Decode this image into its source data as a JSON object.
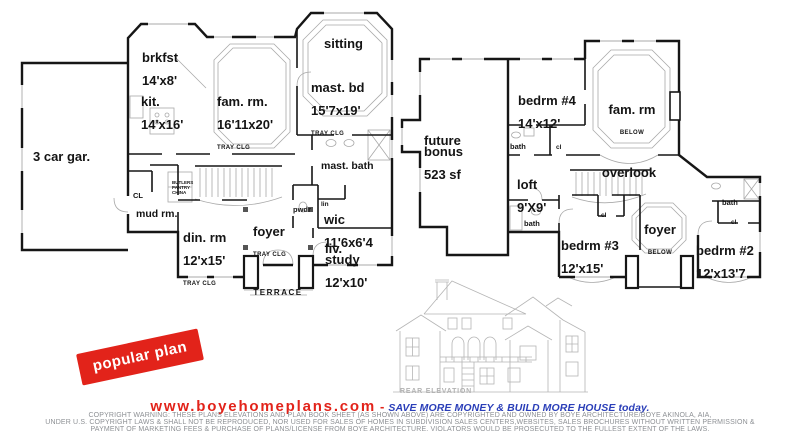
{
  "colors": {
    "wall": "#161616",
    "detail_gray": "#a9a9a9",
    "elevation_gray": "#b5b5b5",
    "stamp_red": "#e2231a",
    "website_red": "#e2231a",
    "tagline_blue": "#2a3eb8",
    "copyright_gray": "#8d9094"
  },
  "first_floor": {
    "garage": {
      "name": "3 car gar."
    },
    "brkfst": {
      "name": "brkfst",
      "dims": "14'x8'"
    },
    "kit": {
      "name": "kit.",
      "dims": "14'x16'"
    },
    "fam_rm": {
      "name": "fam. rm.",
      "dims": "16'11x20'",
      "note": "TRAY CLG"
    },
    "sitting": {
      "name": "sitting"
    },
    "mast_bd": {
      "name": "mast. bd",
      "dims": "15'7x19'",
      "note": "TRAY CLG"
    },
    "mast_bath": {
      "name": "mast. bath"
    },
    "mud_rm": {
      "name": "mud rm."
    },
    "cl": {
      "name": "CL"
    },
    "butlers_pantry": {
      "name": "BUTLERS\nPANTRY\nCHINA"
    },
    "pwdr": {
      "name": "pwdr"
    },
    "lin": {
      "name": "lin"
    },
    "wic": {
      "name": "wic",
      "dims": "11'6x6'4"
    },
    "din_rm": {
      "name": "din. rm",
      "dims": "12'x15'",
      "note": "TRAY CLG"
    },
    "foyer": {
      "name": "foyer",
      "note": "TRAY CLG"
    },
    "liv_study": {
      "name": "liv.\nstudy",
      "dims": "12'x10'"
    },
    "terrace": {
      "name": "TERRACE"
    }
  },
  "second_floor": {
    "future_bonus": {
      "name": "future\nbonus",
      "dims": "523 sf"
    },
    "bedrm4": {
      "name": "bedrm #4",
      "dims": "14'x12'"
    },
    "fam_rm": {
      "name": "fam. rm",
      "note": "BELOW"
    },
    "overlook": {
      "name": "overlook"
    },
    "loft": {
      "name": "loft",
      "dims": "9'X9'"
    },
    "bath_a": {
      "name": "bath"
    },
    "cl_a": {
      "name": "cl"
    },
    "bath_b": {
      "name": "bath"
    },
    "bedrm3": {
      "name": "bedrm #3",
      "dims": "12'x15'"
    },
    "cl_b": {
      "name": "cl"
    },
    "foyer": {
      "name": "foyer",
      "note": "BELOW"
    },
    "bath_c": {
      "name": "bath"
    },
    "cl_c": {
      "name": "cl"
    },
    "bedrm2": {
      "name": "bedrm #2",
      "dims": "12'x13'7"
    }
  },
  "stamp": {
    "label": "popular plan"
  },
  "elevation": {
    "caption": "REAR ELEVATION"
  },
  "footer": {
    "website": "www.boyehomeplans.com",
    "separator": "-",
    "tagline": "SAVE MORE MONEY & BUILD MORE HOUSE today.",
    "copyright": [
      "COPYRIGHT WARNING: THESE PLANS ELEVATIONS AND PLAN BOOK SHEET (AS SHOWN ABOVE) ARE COPYRIGHTED AND OWNED BY BOYE ARCHITECTURE/BOYE AKINOLA, AIA,",
      "UNDER U.S. COPYRIGHT LAWS & SHALL NOT BE REPRODUCED, NOR USED FOR SALES OF HOMES IN SUBDIVISION SALES CENTERS,WEBSITES, SALES BROCHURES WITHOUT WRITTEN PERMISSION &",
      "PAYMENT OF MARKETING FEES & PURCHASE OF PLANS/LICENSE FROM BOYE ARCHITECTURE. VIOLATORS WOULD BE PROSECUTED TO THE FULLEST EXTENT OF THE LAWS."
    ]
  }
}
